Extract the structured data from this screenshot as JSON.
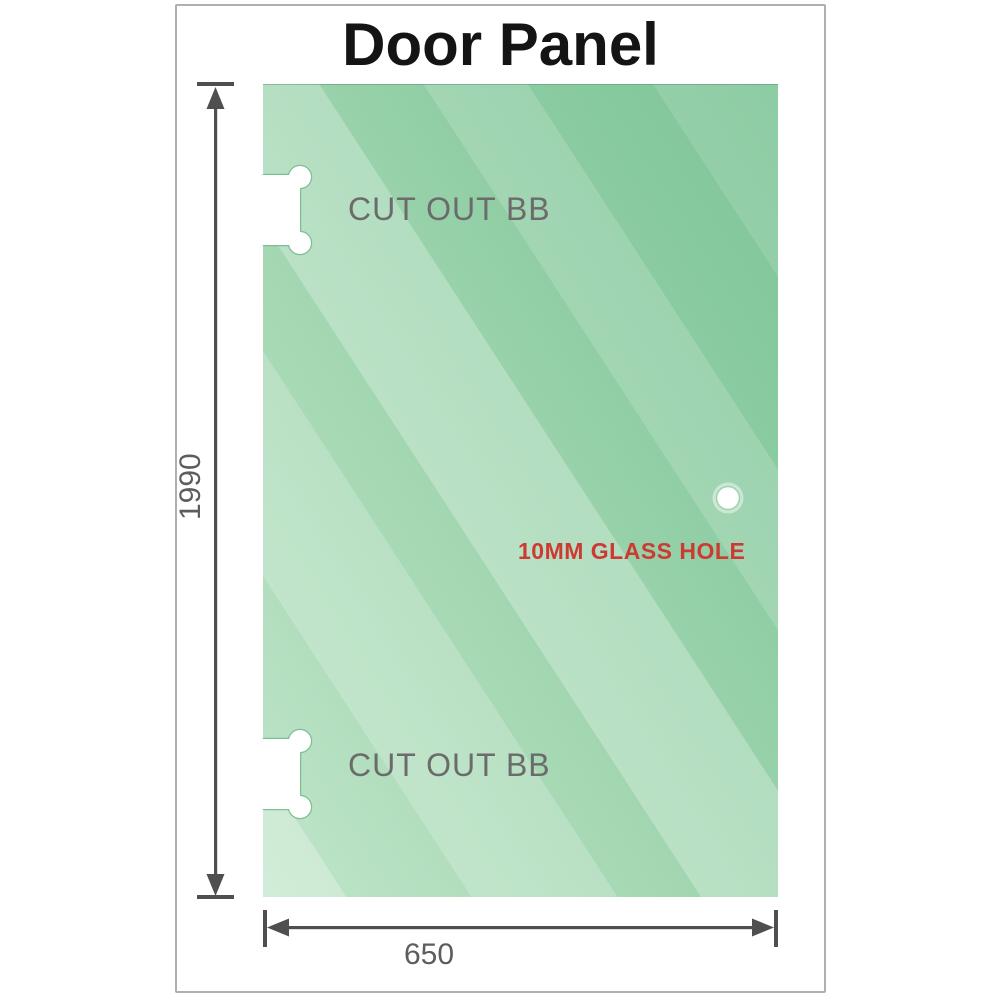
{
  "title": "Door Panel",
  "panel": {
    "cutouts": [
      {
        "label": "CUT OUT BB",
        "position": "top-left"
      },
      {
        "label": "CUT OUT BB",
        "position": "bottom-left"
      }
    ],
    "glass_hole": {
      "label": "10MM GLASS HOLE"
    }
  },
  "dimensions": {
    "height": {
      "value": "1990"
    },
    "width": {
      "value": "650"
    }
  },
  "colors": {
    "glass_green_dark": "#7ec598",
    "glass_green_base": "#8fcda4",
    "glass_green_light": "#c0e5ca",
    "dimension_gray": "#4f4f4f",
    "cutout_label_gray": "#6b6b6b",
    "hole_label_red": "#cd3a31",
    "title_black": "#141414",
    "frame_border_gray": "#b0b0b0",
    "cutout_stroke_green": "#7fbf96"
  }
}
